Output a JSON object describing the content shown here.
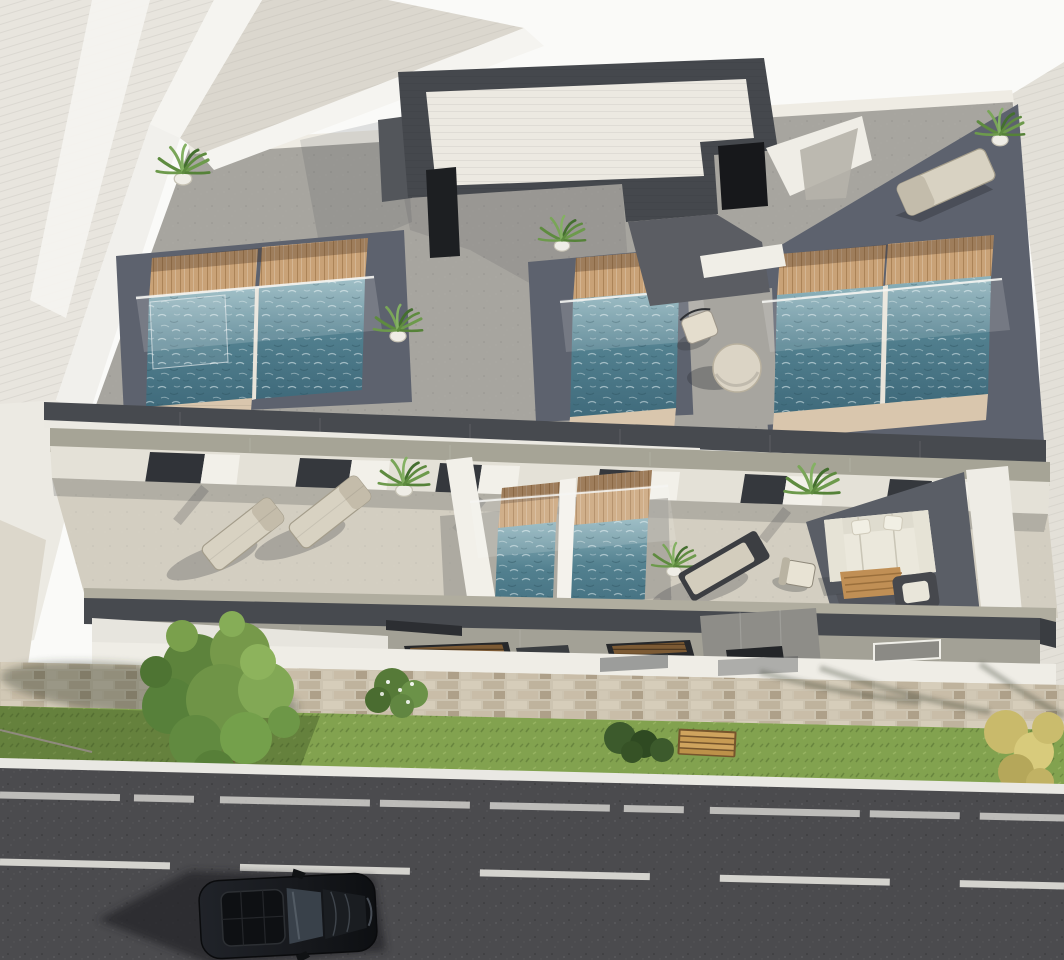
{
  "image": {
    "kind": "3D architectural exterior rendering",
    "view": "aerial perspective from above",
    "subject": "modern residential building with rooftop plunge pools, furnished terraces, cobblestone sidewalk, grass verge and asphalt street with a parked dark car"
  },
  "colors": {
    "sky": "#fafaf8",
    "neighbor_roof": "#e8e5de",
    "roof_coping": "#f5f4f0",
    "back_roof": "#dbd7ce",
    "terrace_gray": "#a7a59f",
    "terrace_dark": "#5d626e",
    "charcoal": "#45484d",
    "penthouse_white": "#ece9e1",
    "opening_dark": "#17181b",
    "wood_deck": "#c9a277",
    "travertine": "#d9c6ad",
    "water_light": "#8fb4bd",
    "water_mid": "#52808f",
    "water_deep": "#3f6a7b",
    "sage_band": "#a6a496",
    "fascia_dark": "#474a4f",
    "wall_white": "#efede6",
    "window_dark": "#303338",
    "terrace_beige": "#d3cec1",
    "carpet_slate": "#5a5e66",
    "furniture_beige": "#d8d2c2",
    "sofa_white": "#ebe8dc",
    "table_wood": "#c08f55",
    "awning_gray": "#a3a196",
    "cobble_base": "#cdc4b1",
    "grass_green": "#82a24f",
    "curb_white": "#e9e8e3",
    "asphalt": "#4b4b4e",
    "road_marking": "#e3e2dd",
    "car_body": "#17191d",
    "car_glass": "#39414a",
    "tree_green": "#76994a",
    "bush_yellow": "#c9ba6b",
    "bench_wood": "#cfa45e",
    "plant_green": "#5e8b3f",
    "pot_white": "#efede6"
  },
  "scene": {
    "building": {
      "levels_visible": 3,
      "rooftop": {
        "plunge_pools": 5,
        "wood_decks": 5,
        "potted_plants": 4,
        "sun_loungers": 1,
        "round_tables": 1,
        "chairs": 1,
        "stair_penthouses": 1,
        "glass_balustrades": true
      },
      "second_level": {
        "plunge_pools": 2,
        "sun_loungers": 3,
        "sofas": 1,
        "armchairs": 2,
        "coffee_tables": 1,
        "potted_plants": 3,
        "glass_balustrades": true
      }
    },
    "street": {
      "parked_cars": 1,
      "trees": 1,
      "benches": 1,
      "bushes": 3,
      "lane_marking_style": "white dashed",
      "sidewalk_style": "cobblestone",
      "grass_verge": true
    }
  }
}
